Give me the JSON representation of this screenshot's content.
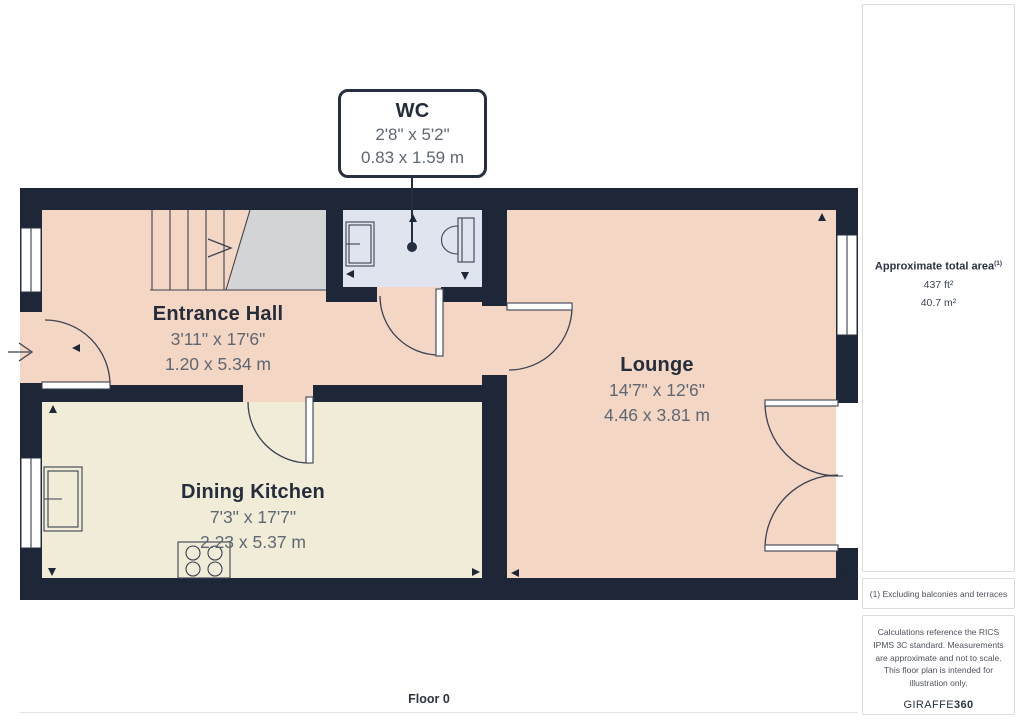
{
  "callout": {
    "room": "WC",
    "dim_imperial": "2'8\" x 5'2\"",
    "dim_metric": "0.83 x 1.59 m"
  },
  "rooms": [
    {
      "name": "Entrance Hall",
      "dim_imperial": "3'11\" x 17'6\"",
      "dim_metric": "1.20 x 5.34 m"
    },
    {
      "name": "Lounge",
      "dim_imperial": "14'7\" x 12'6\"",
      "dim_metric": "4.46 x 3.81 m"
    },
    {
      "name": "Dining Kitchen",
      "dim_imperial": "7'3\" x 17'7\"",
      "dim_metric": "2.23 x 5.37 m"
    }
  ],
  "sidebar": {
    "total_area_label": "Approximate total area",
    "total_area_superscript": "(1)",
    "area_ft": "437 ft²",
    "area_m": "40.7 m²",
    "footnote": "(1) Excluding balconies and terraces",
    "disclaimer": "Calculations reference the RICS IPMS 3C standard. Measurements are approximate and not to scale. This floor plan is intended for illustration only.",
    "brand_primary": "GIRAFFE",
    "brand_secondary": "360"
  },
  "footer": {
    "floor_label": "Floor 0"
  },
  "colors": {
    "wall": "#1e2737",
    "floor_warm": "#f3d6c3",
    "floor_kitchen": "#f0ecd8",
    "floor_wc": "#dfe4ef",
    "stairs": "#d3d4d6"
  }
}
